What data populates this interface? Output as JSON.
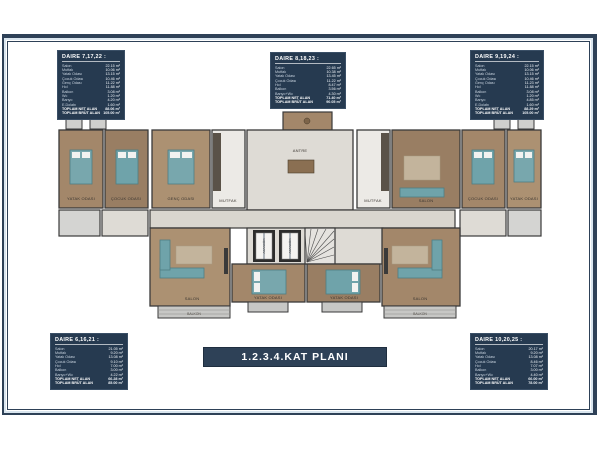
{
  "page": {
    "background": "#ffffff",
    "frame_color": "#2e4157",
    "frame_gap_color": "#d9e5ee"
  },
  "title_box": {
    "label": "1.2.3.4.KAT PLANI",
    "bg": "#2e4157",
    "text_color": "#ffffff"
  },
  "info_boxes": [
    {
      "id": "daire-7-17-22",
      "title": "DAIRE 7,17,22 :",
      "rows": [
        {
          "label": "Salon",
          "value": "22.15 m²"
        },
        {
          "label": "Mutfak",
          "value": "10.06 m²"
        },
        {
          "label": "Yatak Odası",
          "value": "13.15 m²"
        },
        {
          "label": "Çocuk Odası",
          "value": "10.46 m²"
        },
        {
          "label": "Genç Odası",
          "value": "11.22 m²"
        },
        {
          "label": "Hol",
          "value": "11.88 m²"
        },
        {
          "label": "Balkon",
          "value": "3.08 m²"
        },
        {
          "label": "Wc",
          "value": "1.20 m²"
        },
        {
          "label": "Banyo",
          "value": "4.20 m²"
        },
        {
          "label": "E.Dolabı",
          "value": "1.60 m²"
        },
        {
          "label": "TOPLAM NET ALAN",
          "value": "88.06 m²"
        },
        {
          "label": "TOPLAM BRÜT ALAN",
          "value": "105.00 m²"
        }
      ]
    },
    {
      "id": "daire-8-18-23",
      "title": "DAIRE 8,18,23 :",
      "rows": [
        {
          "label": "Salon",
          "value": "22.65 m²"
        },
        {
          "label": "Mutfak",
          "value": "10.38 m²"
        },
        {
          "label": "Yatak Odası",
          "value": "13.45 m²"
        },
        {
          "label": "Çocuk Odası",
          "value": "11.22 m²"
        },
        {
          "label": "Hol",
          "value": "8.47 m²"
        },
        {
          "label": "Balkon",
          "value": "3.56 m²"
        },
        {
          "label": "Banyo+Wc",
          "value": "4.30 m²"
        },
        {
          "label": "TOPLAM NET ALAN",
          "value": "71.40 m²"
        },
        {
          "label": "TOPLAM BRÜT ALAN",
          "value": "90.05 m²"
        }
      ]
    },
    {
      "id": "daire-9-19-24",
      "title": "DAIRE 9,19,24 :",
      "rows": [
        {
          "label": "Salon",
          "value": "22.15 m²"
        },
        {
          "label": "Mutfak",
          "value": "10.06 m²"
        },
        {
          "label": "Yatak Odası",
          "value": "13.15 m²"
        },
        {
          "label": "Çocuk Odası",
          "value": "10.46 m²"
        },
        {
          "label": "Genç Odası",
          "value": "11.23 m²"
        },
        {
          "label": "Hol",
          "value": "11.88 m²"
        },
        {
          "label": "Balkon",
          "value": "3.08 m²"
        },
        {
          "label": "Wc",
          "value": "1.20 m²"
        },
        {
          "label": "Banyo",
          "value": "4.85 m²"
        },
        {
          "label": "E.Dolabı",
          "value": "1.60 m²"
        },
        {
          "label": "TOPLAM NET ALAN",
          "value": "88.29 m²"
        },
        {
          "label": "TOPLAM BRÜT ALAN",
          "value": "105.00 m²"
        }
      ]
    },
    {
      "id": "daire-6-16-21",
      "title": "DAIRE 6,16,21 :",
      "rows": [
        {
          "label": "Salon",
          "value": "21.05 m²"
        },
        {
          "label": "Mutfak",
          "value": "9.20 m²"
        },
        {
          "label": "Yatak Odası",
          "value": "13.08 m²"
        },
        {
          "label": "Çocuk Odası",
          "value": "9.10 m²"
        },
        {
          "label": "Hol",
          "value": "7.00 m²"
        },
        {
          "label": "Balkon",
          "value": "3.00 m²"
        },
        {
          "label": "Banyo+Wc",
          "value": "4.22 m²"
        },
        {
          "label": "TOPLAM NET ALAN",
          "value": "66.28 m²"
        },
        {
          "label": "TOPLAM BRÜT ALAN",
          "value": "85.00 m²"
        }
      ]
    },
    {
      "id": "daire-10-20-25",
      "title": "DAIRE 10,20,25 :",
      "rows": [
        {
          "label": "Salon",
          "value": "20.17 m²"
        },
        {
          "label": "Mutfak",
          "value": "9.20 m²"
        },
        {
          "label": "Yatak Odası",
          "value": "13.08 m²"
        },
        {
          "label": "Çocuk Odası",
          "value": "8.46 m²"
        },
        {
          "label": "Hol",
          "value": "7.07 m²"
        },
        {
          "label": "Balkon",
          "value": "3.00 m²"
        },
        {
          "label": "Banyo+Wc",
          "value": "4.40 m²"
        },
        {
          "label": "TOPLAM NET ALAN",
          "value": "66.00 m²"
        },
        {
          "label": "TOPLAM BRÜT ALAN",
          "value": "78.00 m²"
        }
      ]
    }
  ],
  "plan": {
    "labels": {
      "salon": "SALON",
      "mutfak": "MUTFAK",
      "yatak_odasi": "YATAK ODASI",
      "cocuk_odasi": "ÇOCUK ODASI",
      "genc_odasi": "GENÇ ODASI",
      "antre": "ANTRE",
      "balkon": "BALKON",
      "asansor": "ASANSÖR"
    },
    "colors": {
      "wall": "#3a3a3a",
      "wood_a": "#a3876a",
      "wood_b": "#997e63",
      "wood_c": "#ac9172",
      "tile": "#eceae6",
      "marble": "#dedbd5",
      "bath": "#d4d4d2",
      "balcony": "#c7c7c5",
      "furniture_teal": "#78a7ad",
      "rug": "#c3b49c"
    }
  }
}
